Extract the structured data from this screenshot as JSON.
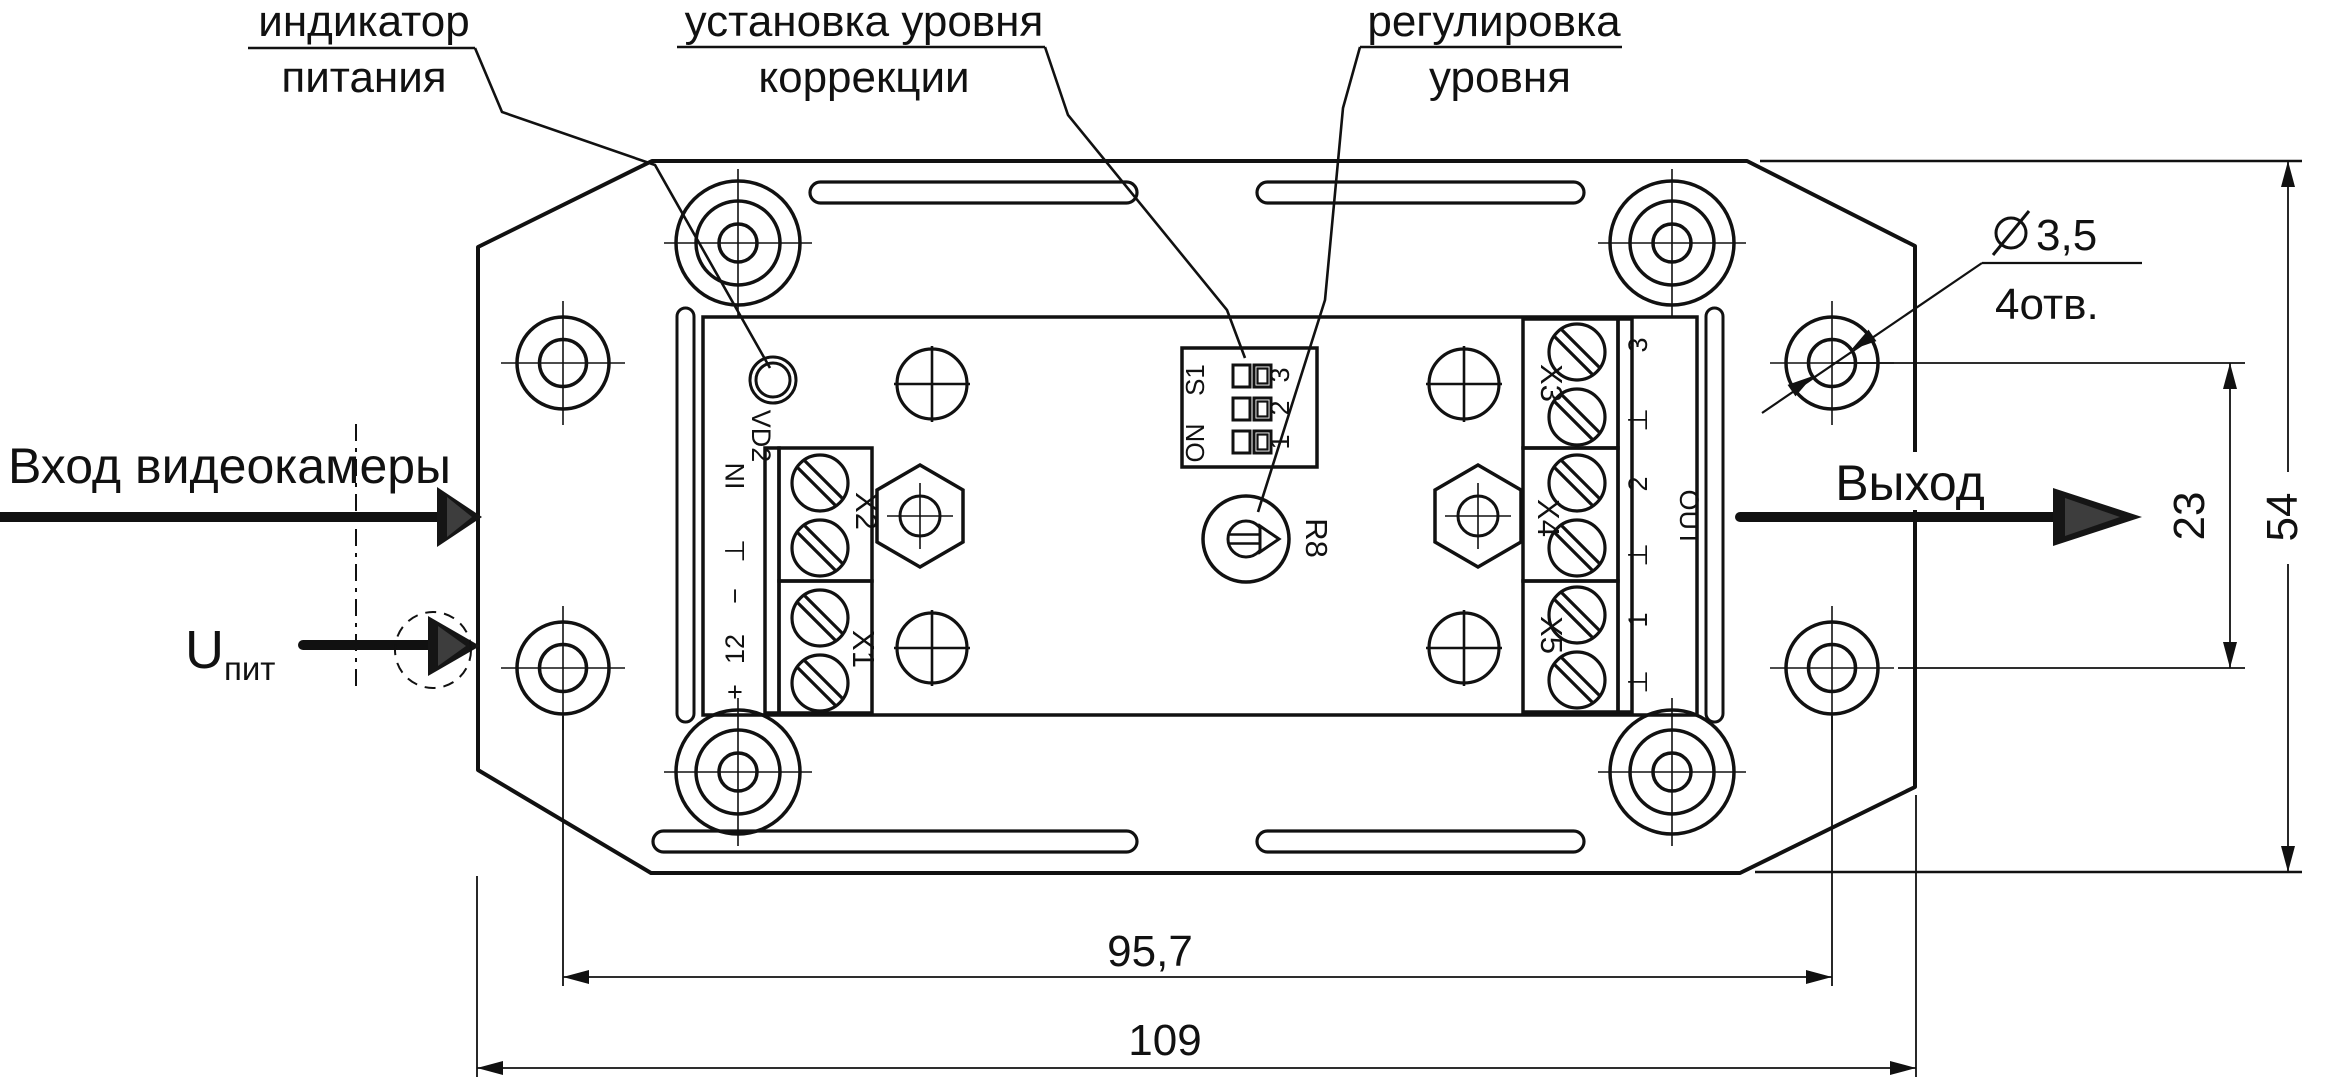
{
  "callouts": {
    "power_indicator_line1": "индикатор",
    "power_indicator_line2": "питания",
    "correction_level_line1": "установка уровня",
    "correction_level_line2": "коррекции",
    "level_adjust_line1": "регулировка",
    "level_adjust_line2": "уровня"
  },
  "io": {
    "camera_input": "Вход видеокамеры",
    "supply_symbol": "U",
    "supply_subscript": "пит",
    "output": "Выход"
  },
  "dims": {
    "hole_pitch_h": "95,7",
    "overall_width": "109",
    "hole_pitch_v": "23",
    "overall_height": "54",
    "hole_diameter": "3,5",
    "holes_count": "4отв."
  },
  "pcb": {
    "led_ref": "VD2",
    "dip_ref": "S1",
    "dip_on": "ON",
    "dip_pin1": "1",
    "dip_pin2": "2",
    "dip_pin3": "3",
    "pot_ref": "R8",
    "term_x1": "X1",
    "term_x2": "X2",
    "term_x3": "X3",
    "term_x4": "X4",
    "term_x5": "X5",
    "pin_in": "IN",
    "gnd": "⊥",
    "pin_minus": "−",
    "pin_12": "12",
    "pin_plus": "+",
    "pin_out": "OUT",
    "pin_1": "1",
    "pin_2": "2",
    "pin_3": "3"
  }
}
